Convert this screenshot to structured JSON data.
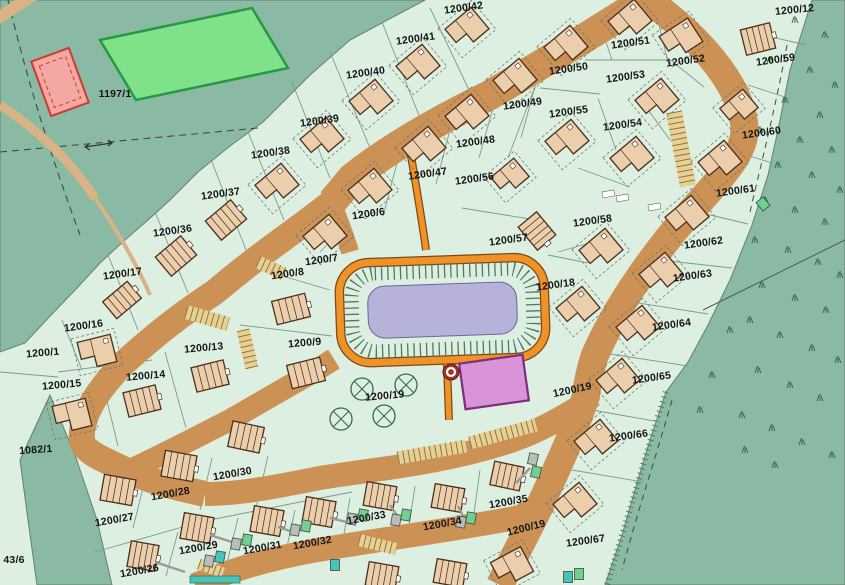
{
  "map": {
    "type": "cadastral-development-plan",
    "colors": {
      "parcel": "#ddefe0",
      "rough_land": "#8abaa3",
      "road": "#cc9255",
      "path_orange": "#ef9227",
      "path_outline": "#7a4a18",
      "pond": "#b6b2d9",
      "pond_outline": "#6b6798",
      "hatch_green": "#4e7a5e",
      "field_green": "#7fe18a",
      "field_border": "#259a43",
      "red_building_fill": "#f3a8a3",
      "red_building_border": "#cf3a31",
      "playground": "#d993d9",
      "playground_border": "#7c2e7c",
      "parking": "#e6d094",
      "parking_tick": "#8a6b35",
      "house_fill": "#ebcfad",
      "house_outline": "#4a2f1e",
      "marker_red": "#a5322a",
      "tree_green": "#3a6b4f",
      "veg_green": "#2f6b50",
      "boundary_line": "#7d9a8c",
      "sage_outline": "#64806f",
      "garage_gray": "#b9beba",
      "garage_green": "#6fd08f",
      "garage_teal": "#46c4b8",
      "label_color": "#141414"
    },
    "labels": [
      {
        "text": "1197/1",
        "x": 115,
        "y": 97,
        "r": 0
      },
      {
        "text": "1082/1",
        "x": 36,
        "y": 453,
        "r": -4
      },
      {
        "text": "43/6",
        "x": 14,
        "y": 563,
        "r": 0
      },
      {
        "text": "1200/12",
        "x": 795,
        "y": 13,
        "r": -6
      },
      {
        "text": "1200/42",
        "x": 464,
        "y": 11,
        "r": -8
      },
      {
        "text": "1200/41",
        "x": 416,
        "y": 42,
        "r": -8
      },
      {
        "text": "1200/40",
        "x": 366,
        "y": 76,
        "r": -8
      },
      {
        "text": "1200/39",
        "x": 320,
        "y": 124,
        "r": -8
      },
      {
        "text": "1200/38",
        "x": 271,
        "y": 156,
        "r": -8
      },
      {
        "text": "1200/37",
        "x": 221,
        "y": 197,
        "r": -8
      },
      {
        "text": "1200/36",
        "x": 173,
        "y": 234,
        "r": -8
      },
      {
        "text": "1200/17",
        "x": 123,
        "y": 277,
        "r": -8
      },
      {
        "text": "1200/16",
        "x": 84,
        "y": 329,
        "r": -8
      },
      {
        "text": "1200/1",
        "x": 43,
        "y": 356,
        "r": -5
      },
      {
        "text": "1200/15",
        "x": 62,
        "y": 388,
        "r": -5
      },
      {
        "text": "1200/14",
        "x": 146,
        "y": 379,
        "r": -5
      },
      {
        "text": "1200/13",
        "x": 204,
        "y": 351,
        "r": -5
      },
      {
        "text": "1200/6",
        "x": 369,
        "y": 217,
        "r": -8
      },
      {
        "text": "1200/7",
        "x": 322,
        "y": 263,
        "r": -8
      },
      {
        "text": "1200/8",
        "x": 288,
        "y": 277,
        "r": -8
      },
      {
        "text": "1200/9",
        "x": 305,
        "y": 346,
        "r": -5
      },
      {
        "text": "1200/47",
        "x": 428,
        "y": 177,
        "r": -8
      },
      {
        "text": "1200/48",
        "x": 476,
        "y": 145,
        "r": -8
      },
      {
        "text": "1200/49",
        "x": 523,
        "y": 107,
        "r": -8
      },
      {
        "text": "1200/56",
        "x": 475,
        "y": 182,
        "r": -8
      },
      {
        "text": "1200/57",
        "x": 509,
        "y": 243,
        "r": -8
      },
      {
        "text": "1200/18",
        "x": 556,
        "y": 288,
        "r": -8
      },
      {
        "text": "1200/50",
        "x": 569,
        "y": 72,
        "r": -8
      },
      {
        "text": "1200/51",
        "x": 631,
        "y": 46,
        "r": -8
      },
      {
        "text": "1200/52",
        "x": 686,
        "y": 64,
        "r": -8
      },
      {
        "text": "1200/53",
        "x": 626,
        "y": 80,
        "r": -8
      },
      {
        "text": "1200/54",
        "x": 623,
        "y": 128,
        "r": -8
      },
      {
        "text": "1200/55",
        "x": 569,
        "y": 115,
        "r": -8
      },
      {
        "text": "1200/59",
        "x": 776,
        "y": 63,
        "r": -8
      },
      {
        "text": "1200/60",
        "x": 762,
        "y": 136,
        "r": -8
      },
      {
        "text": "1200/61",
        "x": 736,
        "y": 194,
        "r": -8
      },
      {
        "text": "1200/58",
        "x": 593,
        "y": 224,
        "r": -8
      },
      {
        "text": "1200/62",
        "x": 704,
        "y": 246,
        "r": -8
      },
      {
        "text": "1200/63",
        "x": 693,
        "y": 279,
        "r": -8
      },
      {
        "text": "1200/64",
        "x": 672,
        "y": 328,
        "r": -8
      },
      {
        "text": "1200/65",
        "x": 652,
        "y": 381,
        "r": -8
      },
      {
        "text": "1200/66",
        "x": 629,
        "y": 439,
        "r": -8
      },
      {
        "text": "1200/67",
        "x": 586,
        "y": 544,
        "r": -8
      },
      {
        "text": "1200/19",
        "x": 385,
        "y": 399,
        "r": -5
      },
      {
        "text": "1200/19",
        "x": 573,
        "y": 393,
        "r": -12
      },
      {
        "text": "1200/19",
        "x": 527,
        "y": 531,
        "r": -14
      },
      {
        "text": "1200/26",
        "x": 140,
        "y": 574,
        "r": -10
      },
      {
        "text": "1200/27",
        "x": 115,
        "y": 523,
        "r": -10
      },
      {
        "text": "1200/28",
        "x": 171,
        "y": 497,
        "r": -10
      },
      {
        "text": "1200/29",
        "x": 199,
        "y": 551,
        "r": -10
      },
      {
        "text": "1200/30",
        "x": 233,
        "y": 477,
        "r": -10
      },
      {
        "text": "1200/31",
        "x": 263,
        "y": 551,
        "r": -10
      },
      {
        "text": "1200/32",
        "x": 313,
        "y": 546,
        "r": -10
      },
      {
        "text": "1200/33",
        "x": 367,
        "y": 521,
        "r": -10
      },
      {
        "text": "1200/34",
        "x": 443,
        "y": 527,
        "r": -10
      },
      {
        "text": "1200/35",
        "x": 509,
        "y": 505,
        "r": -10
      }
    ]
  }
}
